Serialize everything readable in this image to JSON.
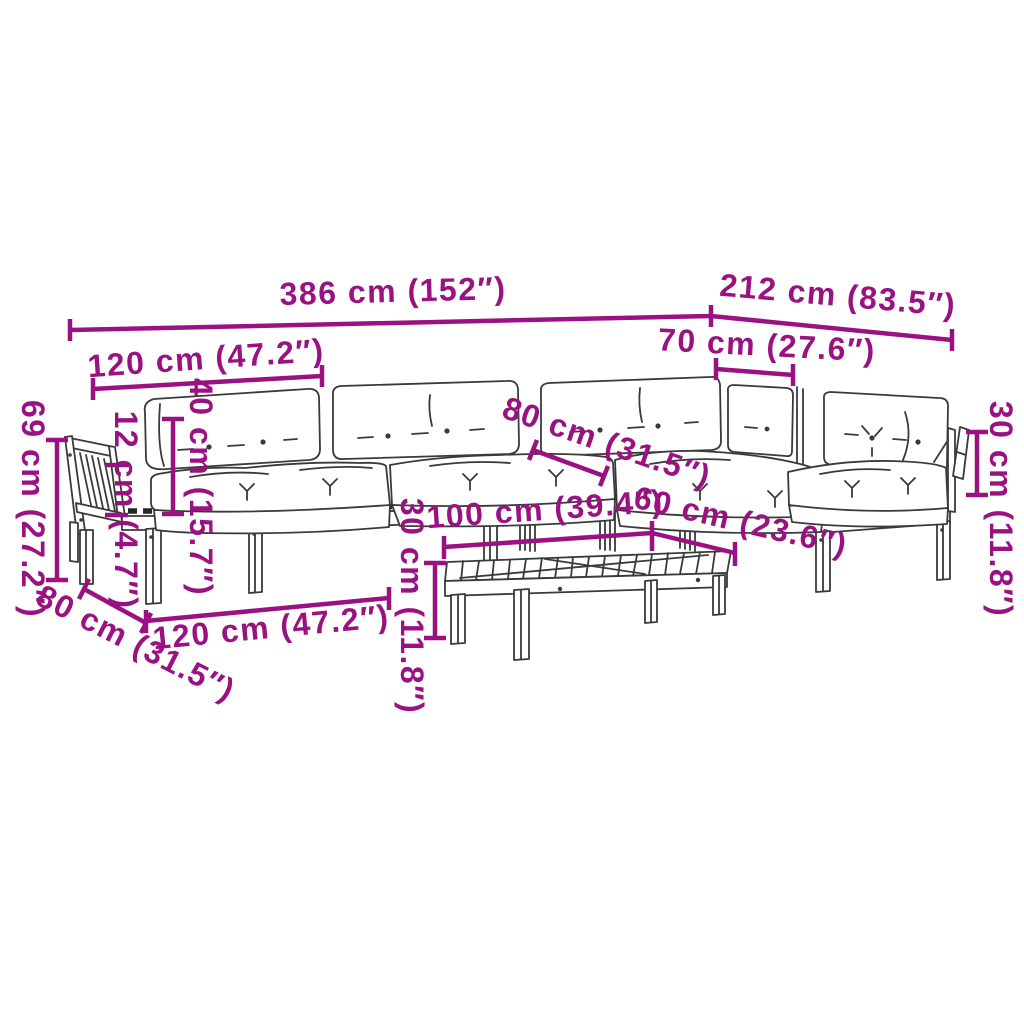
{
  "diagram": {
    "type": "product-dimension-diagram",
    "accent_color": "#9a1282",
    "line_color": "#3a3a3a",
    "background_color": "#ffffff",
    "parts": [
      "pallet-sofa-left-armrest",
      "back-cushions",
      "seat-cushions",
      "pallet-sofa-base",
      "corner-module",
      "right-armrest-bracket",
      "slatted-coffee-table"
    ],
    "dimensions": {
      "total_width": "386 cm (152″)",
      "wing_length": "212 cm (83.5″)",
      "left_module_width_top": "120 cm (47.2″)",
      "corner_seat_width": "70 cm (27.6″)",
      "overall_height": "69 cm (27.2″)",
      "back_cushion_height": "40 cm (15.7″)",
      "seat_cushion_thickness": "12 cm (4.7″)",
      "seat_depth": "80 cm (31.5″)",
      "right_arm_height": "30 cm (11.8″)",
      "table_length": "100 cm (39.4″)",
      "table_width": "60 cm (23.6″)",
      "table_height": "30 cm (11.8″)",
      "left_module_width_bottom": "120 cm (47.2″)",
      "module_depth": "80 cm (31.5″)"
    }
  }
}
